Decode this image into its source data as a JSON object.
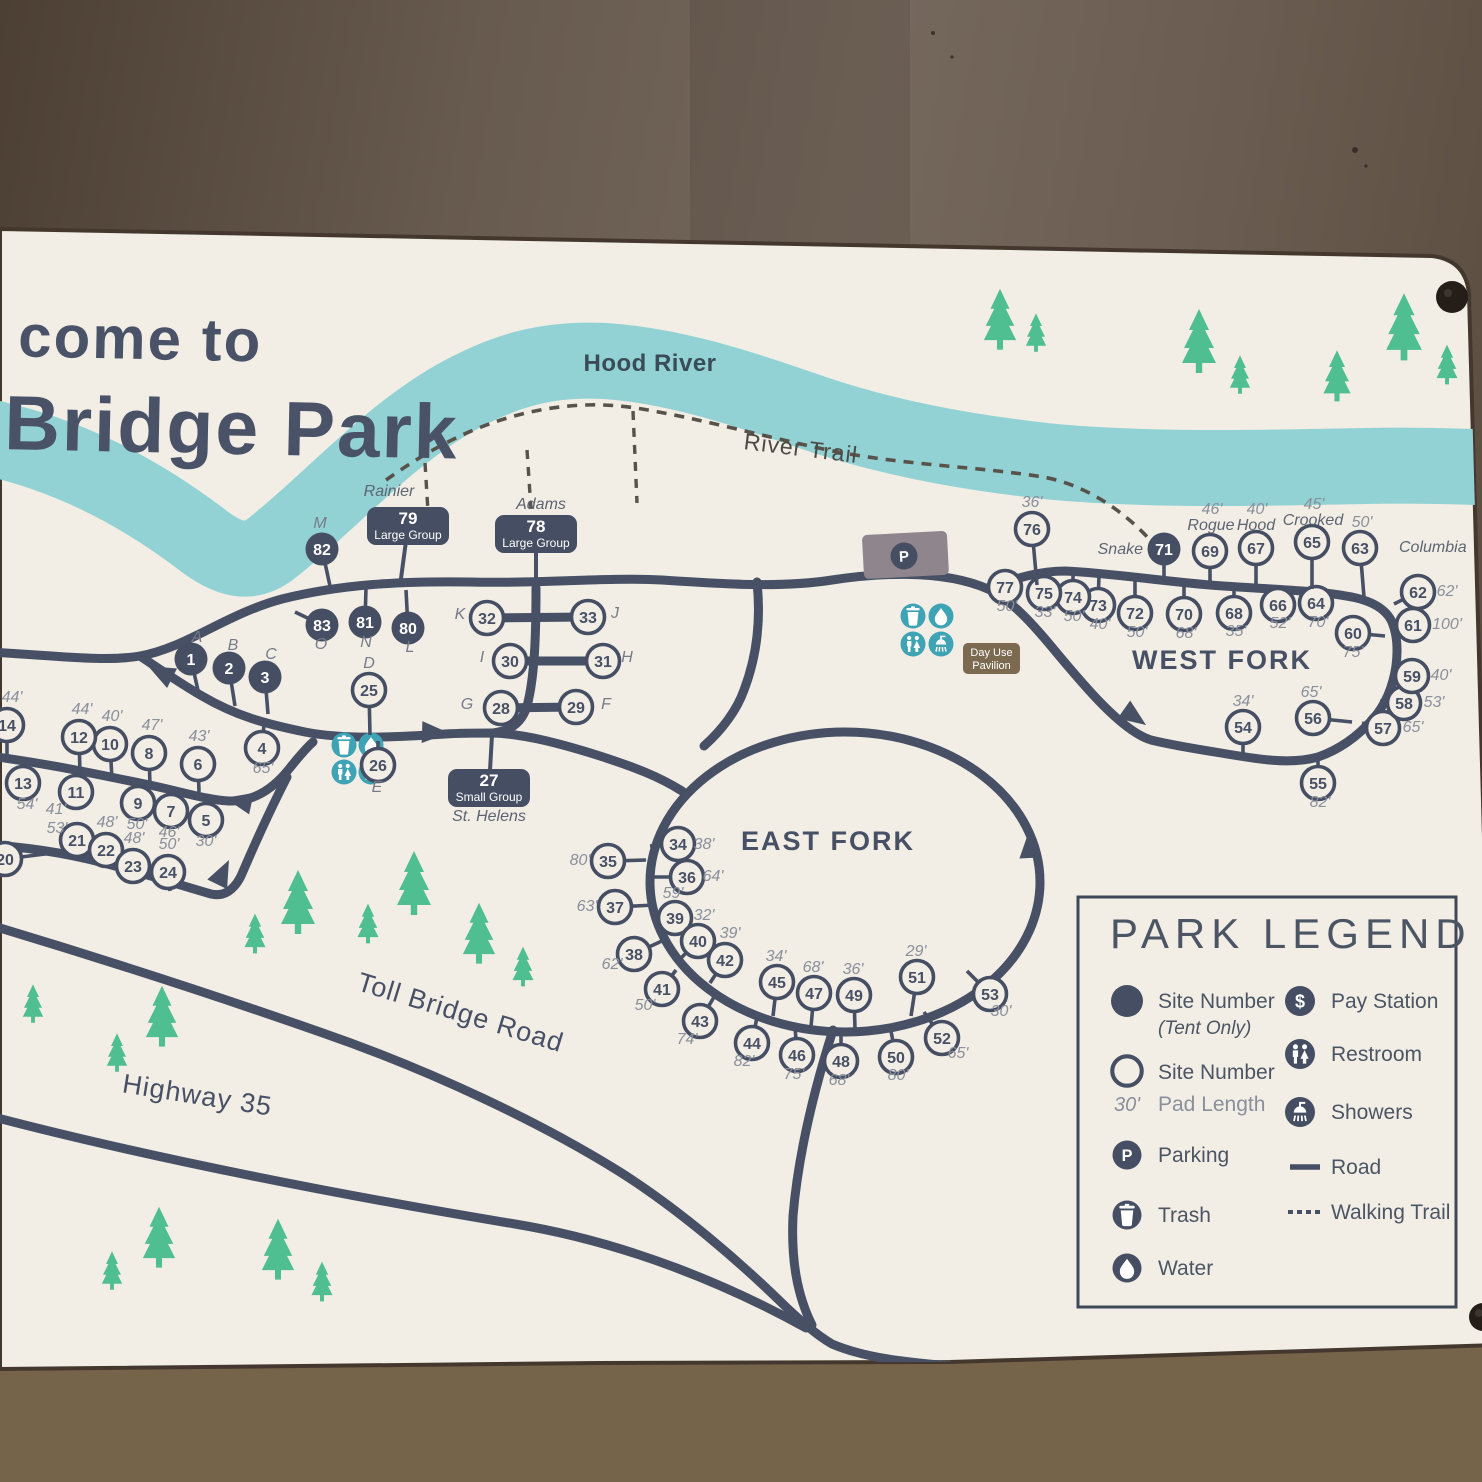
{
  "title": {
    "line1": "come to",
    "line2": "Bridge Park"
  },
  "map_labels": {
    "river": "Hood River",
    "trail": "River Trail",
    "east_fork": "EAST FORK",
    "west_fork": "WEST FORK",
    "toll_road": "Toll Bridge Road",
    "highway": "Highway 35",
    "day_use": [
      "Day Use",
      "Pavilion"
    ],
    "parking_letter": "P"
  },
  "colors": {
    "sign": "#f2eee5",
    "river": "#92d2d4",
    "road": "#475065",
    "trail": "#57524a",
    "tree": "#4fbe90",
    "teal_icon": "#3ea3b5",
    "pad_text": "#8a8f9c",
    "letter_text": "#757b89",
    "badge": "#454e62",
    "brown_badge": "#7b6950",
    "parking_lot": "#8e868c",
    "title_text": "#4a5268",
    "legend_text": "#4b5563",
    "wall_edge": "#44382e"
  },
  "legend": {
    "title": "PARK LEGEND",
    "left": [
      {
        "icon": "site-filled",
        "lines": [
          "Site Number",
          "(Tent Only)"
        ]
      },
      {
        "icon": "site-open",
        "pre": "30'",
        "lines": [
          "Site Number",
          "Pad Length"
        ]
      },
      {
        "icon": "parking",
        "lines": [
          "Parking"
        ]
      },
      {
        "icon": "trash",
        "lines": [
          "Trash"
        ]
      },
      {
        "icon": "water",
        "lines": [
          "Water"
        ]
      }
    ],
    "right": [
      {
        "icon": "pay",
        "lines": [
          "Pay Station"
        ]
      },
      {
        "icon": "restroom",
        "lines": [
          "Restroom"
        ]
      },
      {
        "icon": "shower",
        "lines": [
          "Showers"
        ]
      },
      {
        "icon": "road",
        "lines": [
          "Road"
        ]
      },
      {
        "icon": "trail",
        "lines": [
          "Walking Trail"
        ]
      }
    ]
  },
  "badges": [
    {
      "n": "79",
      "label": "Large Group",
      "spur": "Rainier",
      "x": 408,
      "y": 526,
      "spx": 389,
      "spy": 496,
      "tx": 400,
      "ty": 586
    },
    {
      "n": "78",
      "label": "Large Group",
      "spur": "Adams",
      "x": 536,
      "y": 534,
      "spx": 541,
      "spy": 509,
      "tx": 536,
      "ty": 586
    },
    {
      "n": "27",
      "label": "Small Group",
      "spur": "St. Helens",
      "x": 489,
      "y": 788,
      "spx": 489,
      "spy": 821,
      "tx": 492,
      "ty": 735
    }
  ],
  "sites": [
    {
      "n": "1",
      "x": 191,
      "y": 659,
      "f": 1,
      "t": [
        199,
        695
      ],
      "L": "A",
      "Lx": 197,
      "Ly": 642
    },
    {
      "n": "2",
      "x": 229,
      "y": 668,
      "f": 1,
      "t": [
        235,
        706
      ],
      "L": "B",
      "Lx": 233,
      "Ly": 650
    },
    {
      "n": "3",
      "x": 265,
      "y": 677,
      "f": 1,
      "t": [
        268,
        714
      ],
      "L": "C",
      "Lx": 271,
      "Ly": 659
    },
    {
      "n": "4",
      "x": 262,
      "y": 748,
      "t": [
        264,
        724
      ],
      "d": "65'",
      "dx": 263,
      "dy": 773
    },
    {
      "n": "5",
      "x": 206,
      "y": 820,
      "t": [
        207,
        797
      ],
      "d": "30'",
      "dx": 206,
      "dy": 846
    },
    {
      "n": "6",
      "x": 198,
      "y": 764,
      "t": [
        199,
        792
      ],
      "d": "43'",
      "dx": 199,
      "dy": 741
    },
    {
      "n": "7",
      "x": 171,
      "y": 811,
      "t": [
        172,
        790
      ],
      "d": "46'",
      "dx": 169,
      "dy": 837
    },
    {
      "n": "8",
      "x": 149,
      "y": 753,
      "t": [
        150,
        785
      ],
      "d": "47'",
      "dx": 152,
      "dy": 730
    },
    {
      "n": "9",
      "x": 138,
      "y": 803,
      "t": [
        139,
        783
      ],
      "d": "50'",
      "dx": 137,
      "dy": 829
    },
    {
      "n": "10",
      "x": 110,
      "y": 744,
      "t": [
        112,
        779
      ],
      "d": "40'",
      "dx": 112,
      "dy": 721
    },
    {
      "n": "11",
      "x": 76,
      "y": 792,
      "t": [
        77,
        772
      ],
      "d": "41'",
      "dx": 56,
      "dy": 814
    },
    {
      "n": "12",
      "x": 79,
      "y": 737,
      "t": [
        80,
        773
      ],
      "d": "44'",
      "dx": 82,
      "dy": 714
    },
    {
      "n": "13",
      "x": 23,
      "y": 783,
      "t": [
        24,
        765
      ],
      "d": "54'",
      "dx": 27,
      "dy": 809
    },
    {
      "n": "14",
      "x": 7,
      "y": 725,
      "t": [
        7,
        760
      ],
      "d": "44'",
      "dx": 12,
      "dy": 702
    },
    {
      "n": "20",
      "x": 5,
      "y": 859,
      "t": [
        53,
        853
      ]
    },
    {
      "n": "21",
      "x": 77,
      "y": 840,
      "t": [
        78,
        858
      ],
      "d": "53'",
      "dx": 57,
      "dy": 833
    },
    {
      "n": "22",
      "x": 106,
      "y": 850,
      "t": [
        107,
        867
      ],
      "d": "48'",
      "dx": 107,
      "dy": 827
    },
    {
      "n": "23",
      "x": 133,
      "y": 866,
      "t": [
        134,
        882
      ],
      "d": "48'",
      "dx": 134,
      "dy": 843
    },
    {
      "n": "24",
      "x": 168,
      "y": 872,
      "t": [
        170,
        891
      ],
      "d": "50'",
      "dx": 169,
      "dy": 849
    },
    {
      "n": "25",
      "x": 369,
      "y": 690,
      "t": [
        370,
        735
      ],
      "L": "D",
      "Lx": 369,
      "Ly": 668
    },
    {
      "n": "26",
      "x": 378,
      "y": 765,
      "t": [
        378,
        741
      ],
      "L": "E",
      "Lx": 377,
      "Ly": 792
    },
    {
      "n": "28",
      "x": 501,
      "y": 708,
      "L": "G",
      "Lx": 467,
      "Ly": 709
    },
    {
      "n": "29",
      "x": 576,
      "y": 707,
      "L": "F",
      "Lx": 606,
      "Ly": 709
    },
    {
      "n": "30",
      "x": 510,
      "y": 661,
      "L": "I",
      "Lx": 482,
      "Ly": 662
    },
    {
      "n": "31",
      "x": 603,
      "y": 661,
      "L": "H",
      "Lx": 627,
      "Ly": 662
    },
    {
      "n": "32",
      "x": 487,
      "y": 618,
      "L": "K",
      "Lx": 460,
      "Ly": 619
    },
    {
      "n": "33",
      "x": 588,
      "y": 617,
      "L": "J",
      "Lx": 615,
      "Ly": 618
    },
    {
      "n": "80",
      "x": 408,
      "y": 628,
      "f": 1,
      "t": [
        406,
        590
      ],
      "L": "L",
      "Lx": 410,
      "Ly": 652
    },
    {
      "n": "81",
      "x": 365,
      "y": 622,
      "f": 1,
      "t": [
        366,
        588
      ],
      "L": "N",
      "Lx": 366,
      "Ly": 647
    },
    {
      "n": "82",
      "x": 322,
      "y": 549,
      "f": 1,
      "t": [
        330,
        586
      ],
      "L": "M",
      "Lx": 320,
      "Ly": 528
    },
    {
      "n": "83",
      "x": 322,
      "y": 625,
      "f": 1,
      "t": [
        295,
        612
      ],
      "L": "O",
      "Lx": 321,
      "Ly": 649
    },
    {
      "n": "34",
      "x": 678,
      "y": 844,
      "t": [
        650,
        846
      ],
      "d": "38'",
      "dx": 704,
      "dy": 849
    },
    {
      "n": "35",
      "x": 608,
      "y": 861,
      "t": [
        646,
        860
      ],
      "d": "80'",
      "dx": 580,
      "dy": 865
    },
    {
      "n": "36",
      "x": 687,
      "y": 877,
      "t": [
        652,
        877
      ],
      "d": "64'",
      "dx": 713,
      "dy": 881
    },
    {
      "n": "37",
      "x": 615,
      "y": 907,
      "t": [
        655,
        905
      ],
      "d": "63'",
      "dx": 587,
      "dy": 911
    },
    {
      "n": "38",
      "x": 634,
      "y": 954,
      "t": [
        664,
        940
      ],
      "d": "62'",
      "dx": 612,
      "dy": 969
    },
    {
      "n": "39",
      "x": 675,
      "y": 918,
      "t": [
        660,
        929
      ],
      "d": "59'",
      "dx": 673,
      "dy": 898
    },
    {
      "n": "40",
      "x": 698,
      "y": 941,
      "t": [
        681,
        958
      ],
      "d": "32'",
      "dx": 704,
      "dy": 920
    },
    {
      "n": "41",
      "x": 662,
      "y": 989,
      "t": [
        676,
        970
      ],
      "d": "50'",
      "dx": 645,
      "dy": 1010
    },
    {
      "n": "42",
      "x": 725,
      "y": 960,
      "t": [
        710,
        983
      ],
      "d": "39'",
      "dx": 730,
      "dy": 938
    },
    {
      "n": "43",
      "x": 700,
      "y": 1021,
      "t": [
        714,
        997
      ],
      "d": "74'",
      "dx": 687,
      "dy": 1044
    },
    {
      "n": "44",
      "x": 752,
      "y": 1043,
      "t": [
        757,
        1017
      ],
      "d": "82'",
      "dx": 744,
      "dy": 1066
    },
    {
      "n": "45",
      "x": 777,
      "y": 982,
      "t": [
        773,
        1016
      ],
      "d": "34'",
      "dx": 776,
      "dy": 961
    },
    {
      "n": "46",
      "x": 797,
      "y": 1055,
      "t": [
        795,
        1026
      ],
      "d": "75'",
      "dx": 794,
      "dy": 1079
    },
    {
      "n": "47",
      "x": 814,
      "y": 993,
      "t": [
        811,
        1027
      ],
      "d": "68'",
      "dx": 813,
      "dy": 972
    },
    {
      "n": "48",
      "x": 841,
      "y": 1061,
      "t": [
        841,
        1030
      ],
      "d": "68'",
      "dx": 839,
      "dy": 1085
    },
    {
      "n": "49",
      "x": 854,
      "y": 995,
      "t": [
        855,
        1029
      ],
      "d": "36'",
      "dx": 853,
      "dy": 974
    },
    {
      "n": "50",
      "x": 896,
      "y": 1057,
      "t": [
        890,
        1026
      ],
      "d": "80'",
      "dx": 898,
      "dy": 1080
    },
    {
      "n": "51",
      "x": 917,
      "y": 977,
      "t": [
        911,
        1016
      ],
      "d": "29'",
      "dx": 916,
      "dy": 956
    },
    {
      "n": "52",
      "x": 942,
      "y": 1038,
      "t": [
        924,
        1012
      ],
      "d": "65'",
      "dx": 958,
      "dy": 1058
    },
    {
      "n": "53",
      "x": 990,
      "y": 994,
      "t": [
        967,
        971
      ],
      "d": "30'",
      "dx": 1001,
      "dy": 1016
    },
    {
      "n": "54",
      "x": 1243,
      "y": 727,
      "t": [
        1243,
        754
      ],
      "d": "34'",
      "dx": 1243,
      "dy": 706
    },
    {
      "n": "55",
      "x": 1318,
      "y": 783,
      "t": [
        1318,
        758
      ],
      "d": "82'",
      "dx": 1320,
      "dy": 807
    },
    {
      "n": "56",
      "x": 1313,
      "y": 718,
      "t": [
        1352,
        722
      ],
      "d": "65'",
      "dx": 1311,
      "dy": 697
    },
    {
      "n": "57",
      "x": 1383,
      "y": 728,
      "t": [
        1362,
        723
      ],
      "d": "65'",
      "dx": 1413,
      "dy": 732
    },
    {
      "n": "58",
      "x": 1404,
      "y": 703,
      "t": [
        1380,
        701
      ],
      "d": "53'",
      "dx": 1434,
      "dy": 707
    },
    {
      "n": "59",
      "x": 1412,
      "y": 676,
      "t": [
        1392,
        670
      ],
      "d": "40'",
      "dx": 1441,
      "dy": 680
    },
    {
      "n": "60",
      "x": 1353,
      "y": 633,
      "t": [
        1385,
        636
      ],
      "d": "75'",
      "dx": 1353,
      "dy": 657
    },
    {
      "n": "61",
      "x": 1413,
      "y": 625,
      "t": [
        1396,
        627
      ],
      "d": "100'",
      "dx": 1447,
      "dy": 629
    },
    {
      "n": "62",
      "x": 1418,
      "y": 592,
      "t": [
        1394,
        604
      ],
      "d": "62'",
      "dx": 1447,
      "dy": 596
    },
    {
      "n": "63",
      "x": 1360,
      "y": 548,
      "t": [
        1364,
        597
      ],
      "d": "50'",
      "dx": 1362,
      "dy": 527,
      "sp": "Columbia",
      "spx": 1399,
      "spy": 552,
      "spa": "start"
    },
    {
      "n": "64",
      "x": 1316,
      "y": 603,
      "t": [
        1316,
        592
      ],
      "d": "70'",
      "dx": 1318,
      "dy": 627
    },
    {
      "n": "65",
      "x": 1312,
      "y": 542,
      "t": [
        1312,
        589
      ],
      "d": "45'",
      "dx": 1314,
      "dy": 509,
      "sp": "Crooked",
      "spx": 1313,
      "spy": 525,
      "spa": "middle"
    },
    {
      "n": "66",
      "x": 1278,
      "y": 605,
      "t": [
        1278,
        588
      ],
      "d": "52'",
      "dx": 1280,
      "dy": 628
    },
    {
      "n": "67",
      "x": 1256,
      "y": 548,
      "t": [
        1256,
        586
      ],
      "d": "40'",
      "dx": 1257,
      "dy": 514,
      "sp": "Hood",
      "spx": 1256,
      "spy": 530,
      "spa": "middle"
    },
    {
      "n": "68",
      "x": 1234,
      "y": 613,
      "t": [
        1234,
        585
      ],
      "d": "35'",
      "dx": 1236,
      "dy": 636
    },
    {
      "n": "69",
      "x": 1210,
      "y": 551,
      "t": [
        1210,
        584
      ],
      "d": "46'",
      "dx": 1212,
      "dy": 514,
      "sp": "Rogue",
      "spx": 1211,
      "spy": 530,
      "spa": "middle"
    },
    {
      "n": "70",
      "x": 1184,
      "y": 614,
      "t": [
        1184,
        582
      ],
      "d": "68'",
      "dx": 1186,
      "dy": 638
    },
    {
      "n": "71",
      "x": 1164,
      "y": 549,
      "f": 1,
      "t": [
        1164,
        581
      ],
      "sp": "Snake",
      "spx": 1143,
      "spy": 554,
      "spa": "end"
    },
    {
      "n": "72",
      "x": 1135,
      "y": 613,
      "t": [
        1135,
        579
      ],
      "d": "50'",
      "dx": 1137,
      "dy": 637
    },
    {
      "n": "73",
      "x": 1098,
      "y": 605,
      "t": [
        1099,
        575
      ],
      "d": "40'",
      "dx": 1100,
      "dy": 629
    },
    {
      "n": "74",
      "x": 1073,
      "y": 597,
      "t": [
        1073,
        571
      ],
      "d": "50'",
      "dx": 1074,
      "dy": 621
    },
    {
      "n": "75",
      "x": 1044,
      "y": 593,
      "t": [
        1044,
        571
      ],
      "d": "33'",
      "dx": 1045,
      "dy": 617
    },
    {
      "n": "76",
      "x": 1032,
      "y": 529,
      "t": [
        1037,
        585
      ],
      "d": "36'",
      "dx": 1032,
      "dy": 507
    },
    {
      "n": "77",
      "x": 1005,
      "y": 587,
      "t": [
        1015,
        598
      ],
      "d": "50'",
      "dx": 1007,
      "dy": 611
    }
  ],
  "trees": [
    [
      255,
      936,
      0.62
    ],
    [
      298,
      906,
      1.0
    ],
    [
      368,
      926,
      0.62
    ],
    [
      414,
      887,
      1.0
    ],
    [
      479,
      937,
      0.95
    ],
    [
      523,
      969,
      0.62
    ],
    [
      162,
      1020,
      0.95
    ],
    [
      117,
      1055,
      0.6
    ],
    [
      33,
      1006,
      0.6
    ],
    [
      112,
      1273,
      0.6
    ],
    [
      159,
      1241,
      0.95
    ],
    [
      278,
      1253,
      0.95
    ],
    [
      322,
      1284,
      0.62
    ],
    [
      1000,
      323,
      0.95
    ],
    [
      1036,
      335,
      0.6
    ],
    [
      1199,
      345,
      1.0
    ],
    [
      1240,
      377,
      0.6
    ],
    [
      1337,
      379,
      0.8
    ],
    [
      1404,
      331,
      1.05
    ],
    [
      1447,
      367,
      0.62
    ]
  ],
  "geometry": {
    "sign": "M 0 229 L 1432 256 Q 1466 260 1469 294 L 1498 1345 L 950 1362 L 600 1363 L 0 1369 Z",
    "river": "M -40 432 C 60 448 140 492 205 542 C 232 562 252 564 272 548 C 330 502 385 438 455 398 C 505 370 548 358 605 361 C 665 365 725 382 805 410 C 885 438 965 452 1045 461 C 1145 471 1265 468 1365 466 C 1420 465 1465 466 1520 469",
    "trail_main": "M 386 480 C 420 456 465 428 522 414 C 562 404 602 402 642 409 C 702 419 765 437 833 451 C 903 465 983 467 1043 477 C 1083 484 1122 509 1150 540",
    "trail_branches": [
      "M 424 446 L 428 512",
      "M 527 450 L 531 509",
      "M 633 411 L 637 503"
    ],
    "roads": [
      "M -10 652 C 60 656 106 662 140 656 C 186 648 226 614 282 599 C 342 584 402 581 470 582 C 540 584 602 577 662 580 C 722 584 782 588 832 580 C 872 574 940 568 988 589",
      "M 140 656 C 158 668 178 682 202 696 C 236 716 266 724 305 732 C 345 740 400 737 445 734 C 462 733 478 733 493 733 C 525 734 562 744 600 756 C 634 767 658 776 682 791",
      "M -10 756 C 50 764 95 774 140 783 C 176 790 206 800 229 801 C 253 802 273 789 289 769 C 297 759 305 749 313 742",
      "M -10 845 C 40 848 80 856 115 866 C 150 875 186 887 211 894 C 224 897 234 890 241 876 C 253 848 269 812 287 777",
      "M 536 588 C 536 632 535 676 527 706 C 522 723 510 731 493 733",
      "M 487 618 L 588 617",
      "M 510 661 L 603 661",
      "M 501 708 L 576 707",
      "M 757 582 C 761 620 757 656 744 690 C 737 710 722 730 704 746",
      "M 988 589 C 1015 578 1040 571 1065 571 C 1110 573 1160 581 1210 585 C 1260 589 1312 590 1346 596 C 1372 600 1386 609 1392 622 C 1397 634 1398 650 1396 666 C 1393 686 1386 704 1373 719 C 1359 735 1341 749 1318 757 C 1291 765 1256 759 1221 753 C 1196 749 1171 745 1151 740 C 1121 731 1081 682 1051 646 C 1031 622 1011 600 988 589 Z",
      "M -10 925 C 80 952 200 990 320 1032 C 430 1070 540 1122 620 1172 C 680 1210 740 1262 785 1306 C 800 1320 815 1334 832 1344 C 865 1358 905 1362 950 1366",
      "M -10 1116 C 150 1158 345 1196 515 1224 C 630 1243 732 1287 806 1328",
      "M 833 1030 C 814 1090 798 1156 793 1216 C 791 1260 797 1295 812 1325"
    ],
    "east_fork_loop": {
      "cx": 845,
      "cy": 882,
      "rx": 195,
      "ry": 150
    },
    "arrows": [
      [
        148,
        666,
        207
      ],
      [
        225,
        798,
        192
      ],
      [
        229,
        860,
        -64
      ],
      [
        449,
        733,
        2
      ],
      [
        1146,
        725,
        35
      ],
      [
        1029,
        831,
        -93
      ]
    ],
    "parking": {
      "x": 863,
      "y": 533,
      "w": 85,
      "h": 44,
      "rot": -3,
      "px": 904,
      "py": 556
    },
    "day_use": {
      "x": 963,
      "y": 643,
      "w": 57,
      "h": 31
    },
    "facility_clusters": [
      {
        "x": 344,
        "y": 745,
        "gap": 27,
        "r": 12.5
      },
      {
        "x": 913,
        "y": 616,
        "gap": 28,
        "r": 12.5
      }
    ],
    "label_pos": {
      "river": [
        650,
        371
      ],
      "trail": [
        800,
        456,
        7
      ],
      "east_fork": [
        828,
        850
      ],
      "west_fork": [
        1222,
        669
      ],
      "toll_road": [
        458,
        1021,
        17
      ],
      "highway": [
        196,
        1104,
        9
      ],
      "title1": [
        18,
        356
      ],
      "title2": [
        6,
        449
      ],
      "legend_box": [
        1078,
        897,
        378,
        410
      ]
    },
    "bolts": [
      [
        1452,
        297,
        16
      ],
      [
        1483,
        1317,
        14
      ]
    ]
  }
}
